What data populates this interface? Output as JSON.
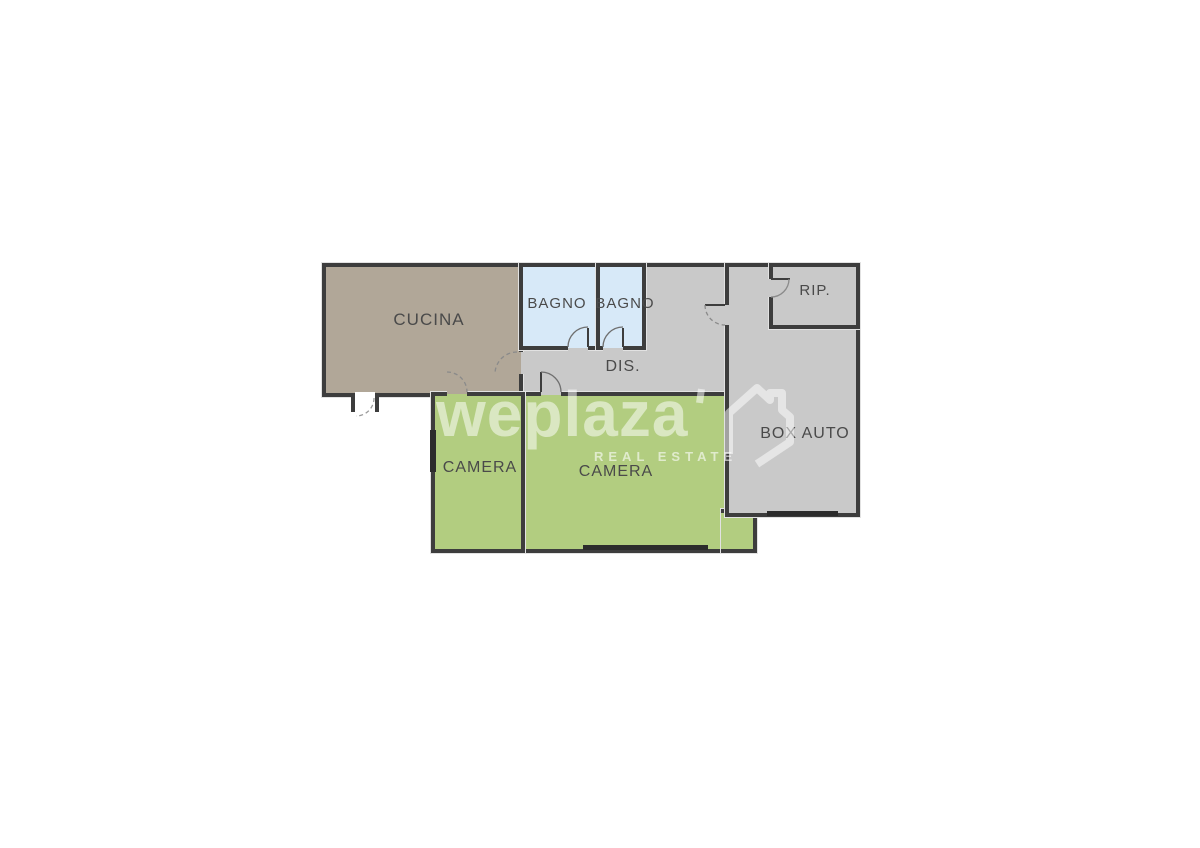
{
  "plan": {
    "rooms": {
      "cucina": {
        "label": "CUCINA",
        "fill": "#b1a798"
      },
      "bagno1": {
        "label": "BAGNO",
        "fill": "#d7e9f8"
      },
      "bagno2": {
        "label": "BAGNO",
        "fill": "#d7e9f8"
      },
      "dis": {
        "label": "DIS.",
        "fill": "#c9c9c9"
      },
      "rip": {
        "label": "RIP.",
        "fill": "#c9c9c9"
      },
      "boxauto": {
        "label": "BOX AUTO",
        "fill": "#c9c9c9"
      },
      "camera1": {
        "label": "CAMERA",
        "fill": "#b2cd80"
      },
      "camera2": {
        "label": "CAMERA",
        "fill": "#b2cd80"
      }
    },
    "wall_color": "#3d3d3d",
    "label_color": "#4a4a4a"
  },
  "watermark": {
    "brand": "weplaza",
    "tagline": "REAL ESTATE",
    "color": "rgba(255,255,255,0.52)"
  }
}
